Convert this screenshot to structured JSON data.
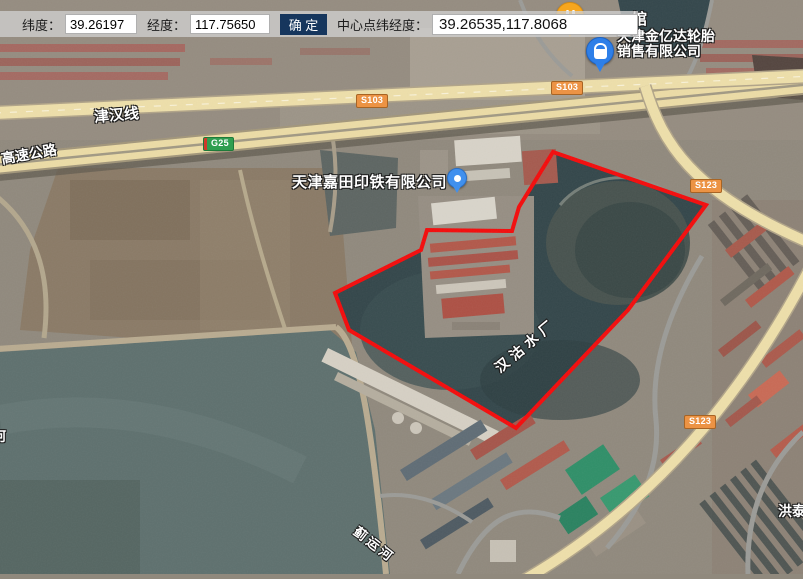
{
  "toolbar": {
    "lat_label": "纬度：",
    "lat_value": "39.26197",
    "lng_label": "经度：",
    "lng_value": "117.75650",
    "confirm_label": "确 定",
    "center_label": "中心点纬经度：",
    "center_value": "39.26535,117.8068"
  },
  "map": {
    "road_labels": {
      "jinhan_line": "津汉线",
      "expressway": "高速公路",
      "hongtai_partial": "洪泰"
    },
    "water_labels": {
      "water_plant": "汉沽水厂",
      "jiyun_river": "蓟运河",
      "river_partial": "河"
    },
    "poi_labels": {
      "jiatian_company": "天津嘉田印铁有限公司",
      "jinyida_line1": "天津金亿达轮胎",
      "jinyida_line2": "销售有限公司",
      "guan_partial": "馆"
    },
    "route_badges": {
      "s103_a": "S103",
      "s103_b": "S103",
      "g25": "G25",
      "s123_a": "S123",
      "s123_b": "S123"
    },
    "colors": {
      "selection_polygon": "#f40b0b",
      "road_fill": "#eedfaa",
      "provincial_badge": "#ec9344",
      "national_badge": "#2f9e50",
      "confirm_button": "#16365d"
    }
  }
}
